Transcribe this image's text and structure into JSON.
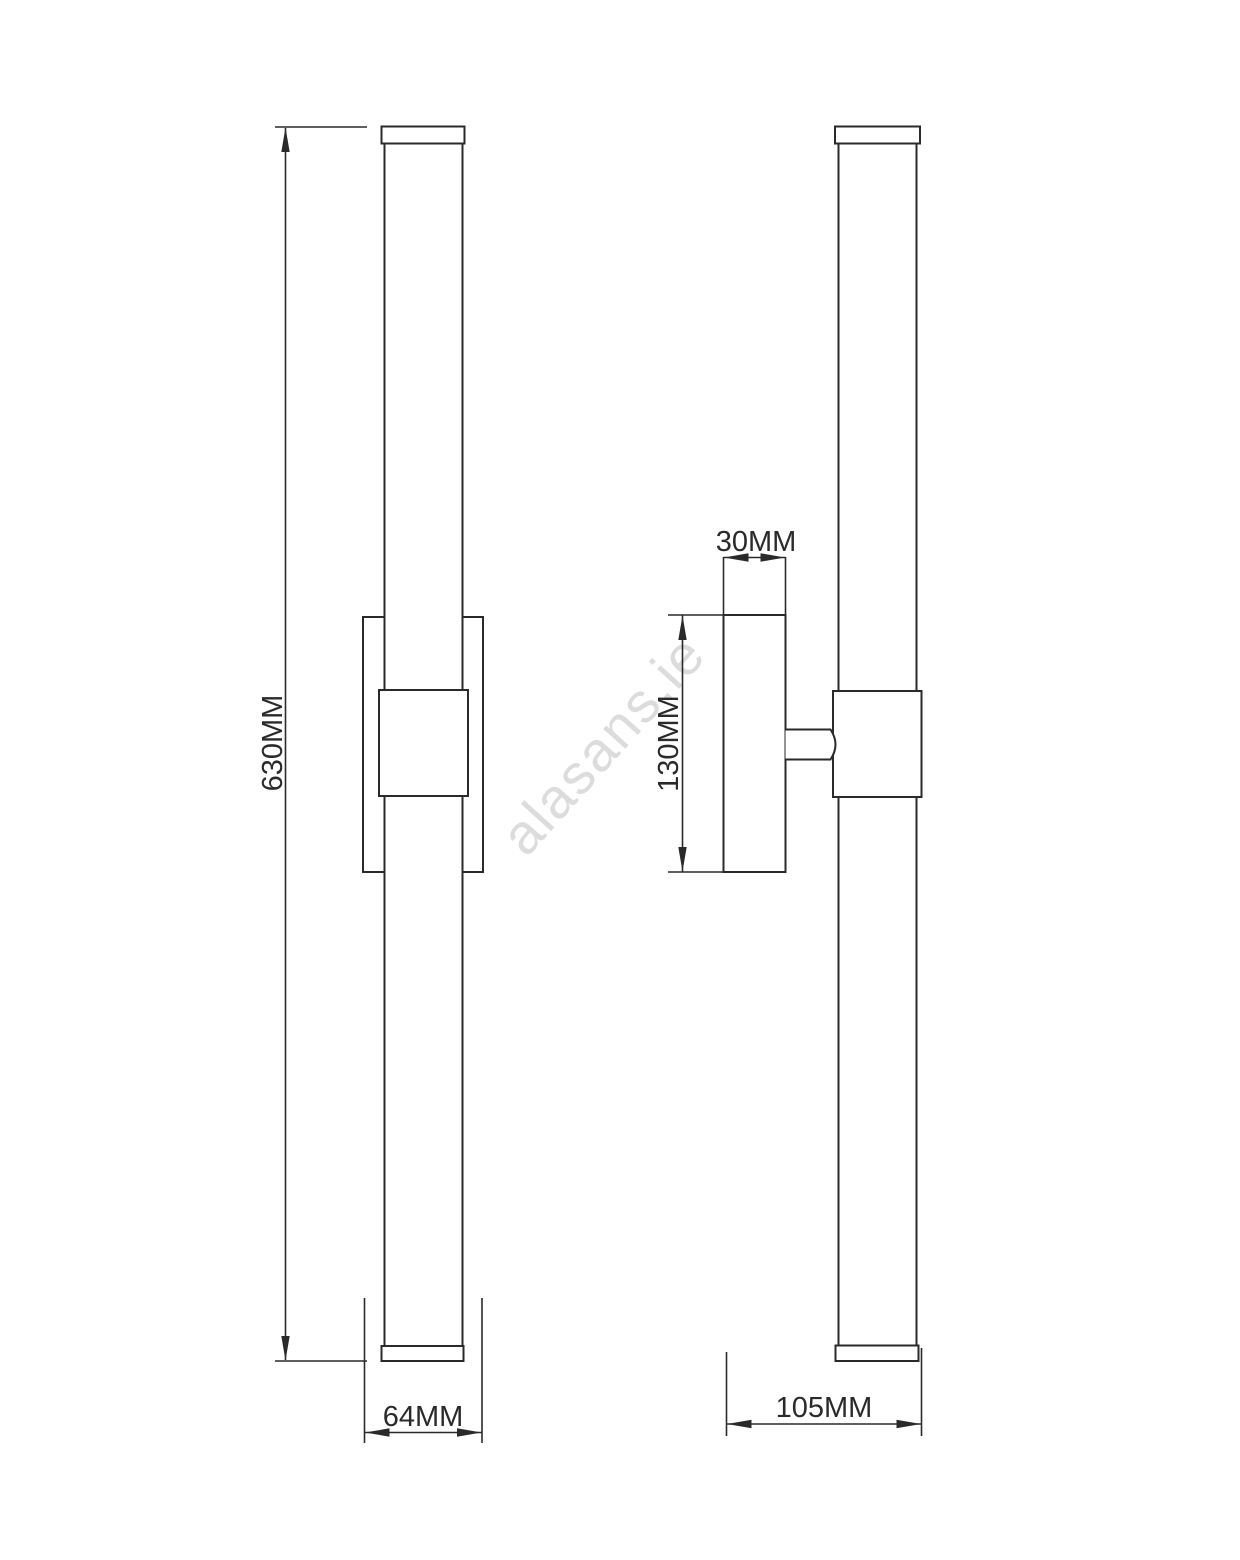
{
  "colors": {
    "line": "#2a2a2a",
    "watermark": "#dcdcdc",
    "background": "#ffffff"
  },
  "watermark": {
    "text": "alasans.ie"
  },
  "drawing": {
    "front_view": {
      "height_label": "630MM",
      "width_label": "64MM"
    },
    "side_view": {
      "plate_depth_label": "30MM",
      "plate_height_label": "130MM",
      "total_depth_label": "105MM"
    }
  }
}
